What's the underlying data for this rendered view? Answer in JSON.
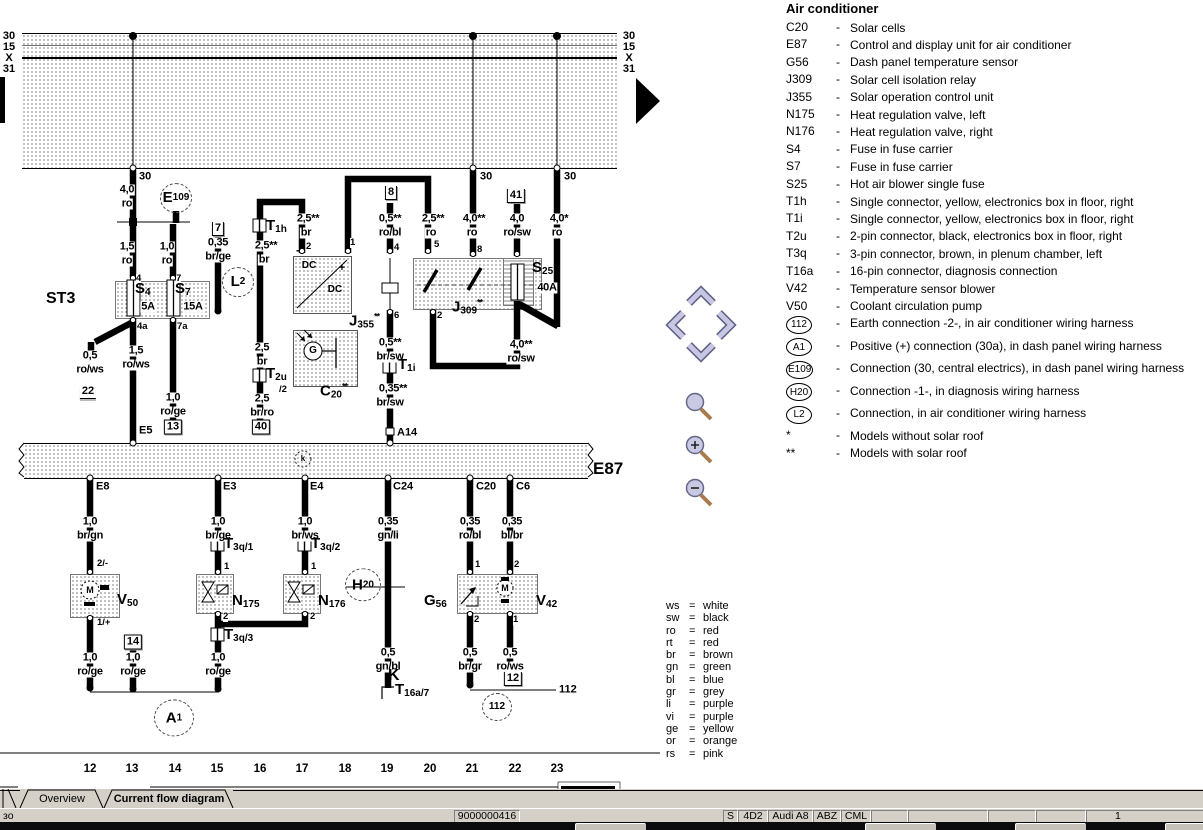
{
  "tabs": [
    {
      "label": "Overview",
      "active": false
    },
    {
      "label": "Current flow diagram",
      "active": true
    }
  ],
  "status_bar": {
    "left_text": "зо",
    "cells": [
      {
        "x": 454,
        "w": 64,
        "t": "9000000416"
      },
      {
        "x": 723,
        "w": 13,
        "t": "S"
      },
      {
        "x": 738,
        "w": 28,
        "t": "4D2"
      },
      {
        "x": 768,
        "w": 43,
        "t": "Audi A8"
      },
      {
        "x": 813,
        "w": 26,
        "t": "ABZ"
      },
      {
        "x": 841,
        "w": 28,
        "t": "CML"
      },
      {
        "x": 871,
        "w": 35,
        "t": ""
      },
      {
        "x": 908,
        "w": 78,
        "t": ""
      },
      {
        "x": 988,
        "w": 46,
        "t": ""
      },
      {
        "x": 1036,
        "w": 48,
        "t": ""
      },
      {
        "x": 1086,
        "w": 116,
        "t": "1"
      }
    ]
  },
  "nav_icons": {
    "scroll_up": "chevron-up",
    "scroll_left": "chevron-left",
    "scroll_right": "chevron-right",
    "scroll_down": "chevron-down",
    "zoom_tool": "magnifier",
    "zoom_in": "magnifier-plus",
    "zoom_out": "magnifier-minus",
    "next_page": "black-right-arrow"
  },
  "legend": {
    "title": "Air conditioner",
    "entries": [
      {
        "code": "C20",
        "desc": "Solar cells"
      },
      {
        "code": "E87",
        "desc": "Control and display unit for air conditioner"
      },
      {
        "code": "G56",
        "desc": "Dash panel temperature sensor"
      },
      {
        "code": "J309",
        "desc": "Solar cell isolation relay"
      },
      {
        "code": "J355",
        "desc": "Solar operation control unit"
      },
      {
        "code": "N175",
        "desc": "Heat regulation valve, left"
      },
      {
        "code": "N176",
        "desc": "Heat regulation valve, right"
      },
      {
        "code": "S4",
        "desc": "Fuse in fuse carrier"
      },
      {
        "code": "S7",
        "desc": "Fuse in fuse carrier"
      },
      {
        "code": "S25",
        "desc": "Hot air blower single fuse"
      },
      {
        "code": "T1h",
        "desc": "Single connector, yellow, electronics box in floor, right"
      },
      {
        "code": "T1i",
        "desc": "Single connector, yellow, electronics box in floor, right"
      },
      {
        "code": "T2u",
        "desc": "2-pin connector, black, electronics box in floor, right"
      },
      {
        "code": "T3q",
        "desc": "3-pin connector, brown, in plenum chamber, left"
      },
      {
        "code": "T16a",
        "desc": "16-pin connector, diagnosis connection"
      },
      {
        "code": "V42",
        "desc": "Temperature sensor blower"
      },
      {
        "code": "V50",
        "desc": "Coolant circulation pump"
      },
      {
        "code": "112",
        "circle": true,
        "desc": "Earth connection -2-, in air conditioner wiring harness"
      },
      {
        "code": "A1",
        "circle": true,
        "desc": "Positive (+) connection (30a), in dash panel wiring harness"
      },
      {
        "code": "E109",
        "circle": true,
        "desc": "Connection (30, central electrics), in dash panel wiring harness"
      },
      {
        "code": "H20",
        "circle": true,
        "desc": "Connection -1-, in diagnosis wiring harness"
      },
      {
        "code": "L2",
        "circle": true,
        "desc": "Connection, in air conditioner wiring harness"
      },
      {
        "code": "*",
        "desc": "Models without solar roof"
      },
      {
        "code": "**",
        "desc": "Models with solar roof"
      }
    ]
  },
  "wire_colors": [
    {
      "abbr": "ws",
      "name": "white"
    },
    {
      "abbr": "sw",
      "name": "black"
    },
    {
      "abbr": "ro",
      "name": "red"
    },
    {
      "abbr": "rt",
      "name": "red"
    },
    {
      "abbr": "br",
      "name": "brown"
    },
    {
      "abbr": "gn",
      "name": "green"
    },
    {
      "abbr": "bl",
      "name": "blue"
    },
    {
      "abbr": "gr",
      "name": "grey"
    },
    {
      "abbr": "li",
      "name": "purple"
    },
    {
      "abbr": "vi",
      "name": "purple"
    },
    {
      "abbr": "ge",
      "name": "yellow"
    },
    {
      "abbr": "or",
      "name": "orange"
    },
    {
      "abbr": "rs",
      "name": "pink"
    }
  ],
  "diagram": {
    "bus_labels_left": [
      [
        9,
        36,
        "30"
      ],
      [
        9,
        47,
        "15"
      ],
      [
        9,
        58,
        "X"
      ],
      [
        9,
        69,
        "31"
      ]
    ],
    "bus_labels_right": [
      [
        629,
        36,
        "30"
      ],
      [
        629,
        47,
        "15"
      ],
      [
        629,
        58,
        "X"
      ],
      [
        629,
        69,
        "31"
      ]
    ],
    "track_numbers": [
      [
        90,
        "12"
      ],
      [
        132,
        "13"
      ],
      [
        175,
        "14"
      ],
      [
        217,
        "15"
      ],
      [
        260,
        "16"
      ],
      [
        302,
        "17"
      ],
      [
        345,
        "18"
      ],
      [
        387,
        "19"
      ],
      [
        430,
        "20"
      ],
      [
        472,
        "21"
      ],
      [
        515,
        "22"
      ],
      [
        557,
        "23"
      ]
    ],
    "track_y": 769,
    "wire_labels": [
      [
        127,
        190,
        "4,0"
      ],
      [
        127,
        204,
        "ro"
      ],
      [
        127,
        247,
        "1,5"
      ],
      [
        127,
        261,
        "ro"
      ],
      [
        167,
        247,
        "1,0"
      ],
      [
        167,
        261,
        "ro"
      ],
      [
        218,
        243,
        "0,35"
      ],
      [
        218,
        257,
        "br/ge"
      ],
      [
        266,
        246,
        "2,5**"
      ],
      [
        264,
        260,
        "br"
      ],
      [
        308,
        219,
        "2,5**"
      ],
      [
        306,
        233,
        "br"
      ],
      [
        390,
        219,
        "0,5**"
      ],
      [
        390,
        233,
        "ro/bl"
      ],
      [
        433,
        219,
        "2,5**"
      ],
      [
        431,
        233,
        "ro"
      ],
      [
        474,
        219,
        "4,0**"
      ],
      [
        472,
        233,
        "ro"
      ],
      [
        517,
        219,
        "4,0"
      ],
      [
        517,
        233,
        "ro/sw"
      ],
      [
        559,
        219,
        "4,0*"
      ],
      [
        557,
        233,
        "ro"
      ],
      [
        262,
        348,
        "2,5"
      ],
      [
        262,
        362,
        "br"
      ],
      [
        262,
        399,
        "2,5"
      ],
      [
        262,
        413,
        "br/ro"
      ],
      [
        390,
        343,
        "0,5**"
      ],
      [
        390,
        357,
        "br/sw"
      ],
      [
        393,
        389,
        "0,35**"
      ],
      [
        390,
        403,
        "br/sw"
      ],
      [
        521,
        345,
        "4,0**"
      ],
      [
        521,
        359,
        "ro/sw"
      ],
      [
        90,
        356,
        "0,5"
      ],
      [
        90,
        370,
        "ro/ws"
      ],
      [
        136,
        351,
        "1,5"
      ],
      [
        136,
        365,
        "ro/ws"
      ],
      [
        173,
        398,
        "1,0"
      ],
      [
        173,
        412,
        "ro/ge"
      ],
      [
        90,
        522,
        "1,0"
      ],
      [
        90,
        536,
        "br/gn"
      ],
      [
        218,
        522,
        "1,0"
      ],
      [
        218,
        536,
        "br/ge"
      ],
      [
        305,
        522,
        "1,0"
      ],
      [
        305,
        536,
        "br/ws"
      ],
      [
        388,
        522,
        "0,35"
      ],
      [
        388,
        536,
        "gn/li"
      ],
      [
        470,
        522,
        "0,35"
      ],
      [
        470,
        536,
        "ro/bl"
      ],
      [
        512,
        522,
        "0,35"
      ],
      [
        512,
        536,
        "bl/br"
      ],
      [
        90,
        658,
        "1,0"
      ],
      [
        90,
        672,
        "ro/ge"
      ],
      [
        133,
        658,
        "1,0"
      ],
      [
        133,
        672,
        "ro/ge"
      ],
      [
        218,
        658,
        "1,0"
      ],
      [
        218,
        672,
        "ro/ge"
      ],
      [
        388,
        653,
        "0,5"
      ],
      [
        388,
        667,
        "gn/bl"
      ],
      [
        470,
        653,
        "0,5"
      ],
      [
        470,
        667,
        "br/gr"
      ],
      [
        510,
        653,
        "0,5"
      ],
      [
        510,
        667,
        "ro/ws"
      ],
      [
        148,
        307,
        "5A"
      ],
      [
        193,
        307,
        "15A"
      ],
      [
        547,
        288,
        "40A"
      ]
    ],
    "pin_labels": [
      [
        136,
        279,
        "4"
      ],
      [
        176,
        279,
        "7"
      ],
      [
        137,
        327,
        "4a"
      ],
      [
        177,
        327,
        "7a"
      ],
      [
        306,
        247,
        "2"
      ],
      [
        350,
        243,
        "1"
      ],
      [
        394,
        248,
        "4"
      ],
      [
        434,
        245,
        "5"
      ],
      [
        477,
        250,
        "8"
      ],
      [
        394,
        316,
        "6"
      ],
      [
        437,
        316,
        "2"
      ],
      [
        279,
        390,
        "/2"
      ],
      [
        97,
        564,
        "2/-"
      ],
      [
        97,
        623,
        "1/+"
      ],
      [
        224,
        567,
        "1"
      ],
      [
        311,
        567,
        "1"
      ],
      [
        223,
        617,
        "2"
      ],
      [
        310,
        617,
        "2"
      ],
      [
        475,
        565,
        "1"
      ],
      [
        514,
        565,
        "2"
      ],
      [
        474,
        620,
        "2"
      ],
      [
        513,
        620,
        "1"
      ]
    ],
    "terminal_labels": [
      [
        139,
        177,
        "30"
      ],
      [
        480,
        177,
        "30"
      ],
      [
        564,
        177,
        "30"
      ],
      [
        139,
        431,
        "E5"
      ],
      [
        397,
        433,
        "A14"
      ],
      [
        96,
        487,
        "E8"
      ],
      [
        223,
        487,
        "E3"
      ],
      [
        310,
        487,
        "E4"
      ],
      [
        393,
        487,
        "C24"
      ],
      [
        476,
        487,
        "C20"
      ],
      [
        516,
        487,
        "C6"
      ],
      [
        559,
        690,
        "112"
      ]
    ],
    "symbol_texts": [
      [
        309,
        266,
        "DC",
        10
      ],
      [
        335,
        290,
        "DC",
        10
      ],
      [
        313,
        351,
        "G",
        10
      ],
      [
        90,
        590,
        "M",
        9
      ],
      [
        505,
        588,
        "M",
        9
      ],
      [
        303,
        459,
        "k",
        8
      ],
      [
        298,
        250,
        "-",
        12
      ],
      [
        342,
        268,
        "+",
        11
      ]
    ],
    "components": [
      {
        "x": 135,
        "y": 291,
        "m": "S",
        "s": "4"
      },
      {
        "x": 175,
        "y": 291,
        "m": "S",
        "s": "7"
      },
      {
        "x": 266,
        "y": 228,
        "m": "T",
        "s": "1h"
      },
      {
        "x": 266,
        "y": 376,
        "m": "T",
        "s": "2u"
      },
      {
        "x": 349,
        "y": 321,
        "m": "J",
        "s": "355",
        "sup": "**"
      },
      {
        "x": 320,
        "y": 391,
        "m": "C",
        "s": "20",
        "sup": "**"
      },
      {
        "x": 452,
        "y": 307,
        "m": "J",
        "s": "309",
        "sup": "**"
      },
      {
        "x": 532,
        "y": 270,
        "m": "S",
        "s": "25"
      },
      {
        "x": 398,
        "y": 367,
        "m": "T",
        "s": "1i"
      },
      {
        "x": 117,
        "y": 602,
        "m": "V",
        "s": "50"
      },
      {
        "x": 232,
        "y": 603,
        "m": "N",
        "s": "175"
      },
      {
        "x": 318,
        "y": 603,
        "m": "N",
        "s": "176"
      },
      {
        "x": 424,
        "y": 603,
        "m": "G",
        "s": "56"
      },
      {
        "x": 536,
        "y": 603,
        "m": "V",
        "s": "42"
      },
      {
        "x": 395,
        "y": 692,
        "m": "T",
        "s": "16a/7"
      },
      {
        "x": 224,
        "y": 546,
        "m": "T",
        "s": "3q/1"
      },
      {
        "x": 311,
        "y": 546,
        "m": "T",
        "s": "3q/2"
      },
      {
        "x": 224,
        "y": 637,
        "m": "T",
        "s": "3q/3"
      }
    ],
    "big_labels": [
      [
        46,
        299,
        "ST3",
        16
      ],
      [
        593,
        469,
        "E87",
        17
      ],
      [
        388,
        676,
        "K",
        16
      ]
    ],
    "circles": [
      {
        "x": 176,
        "y": 198,
        "r": 15,
        "m": "E",
        "s": "109"
      },
      {
        "x": 238,
        "y": 282,
        "r": 15,
        "m": "L",
        "s": "2"
      },
      {
        "x": 363,
        "y": 585,
        "r": 17,
        "m": "H",
        "s": "20"
      },
      {
        "x": 174,
        "y": 718,
        "r": 19,
        "m": "A",
        "s": "1"
      },
      {
        "x": 497,
        "y": 707,
        "r": 14,
        "t": "112"
      }
    ],
    "grounds": [
      {
        "x": 88,
        "y": 392,
        "t": "22",
        "style": "u"
      },
      {
        "x": 173,
        "y": 427,
        "t": "13",
        "style": "b"
      },
      {
        "x": 261,
        "y": 427,
        "t": "40",
        "style": "b"
      },
      {
        "x": 133,
        "y": 642,
        "t": "14",
        "style": "b"
      },
      {
        "x": 513,
        "y": 679,
        "t": "12",
        "style": "k"
      },
      {
        "x": 218,
        "y": 229,
        "t": "7",
        "style": "k"
      },
      {
        "x": 391,
        "y": 193,
        "t": "8",
        "style": "k"
      },
      {
        "x": 516,
        "y": 196,
        "t": "41",
        "style": "k"
      }
    ]
  }
}
